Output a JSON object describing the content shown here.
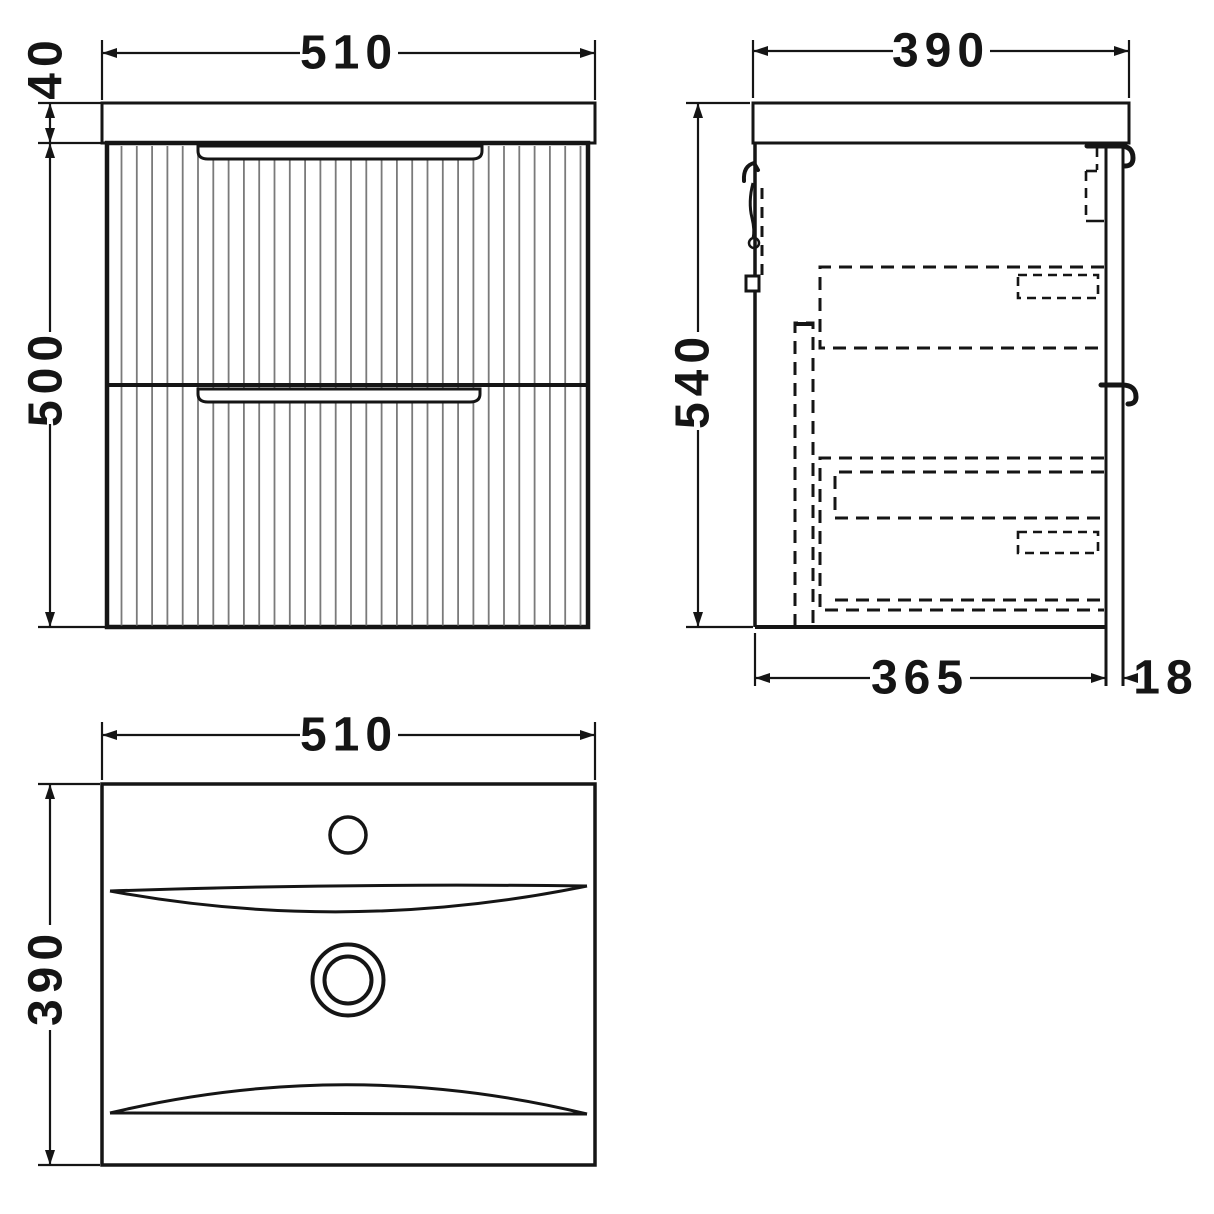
{
  "colors": {
    "line": "#151515",
    "flute": "#7a7a7a"
  },
  "views": {
    "front": {
      "width_mm": "510",
      "worktop_height_mm": "40",
      "cabinet_height_mm": "500"
    },
    "side": {
      "depth_mm": "390",
      "height_mm": "540",
      "carcass_depth_mm": "365",
      "back_panel_mm": "18"
    },
    "plan": {
      "width_mm": "510",
      "depth_mm": "390"
    }
  }
}
